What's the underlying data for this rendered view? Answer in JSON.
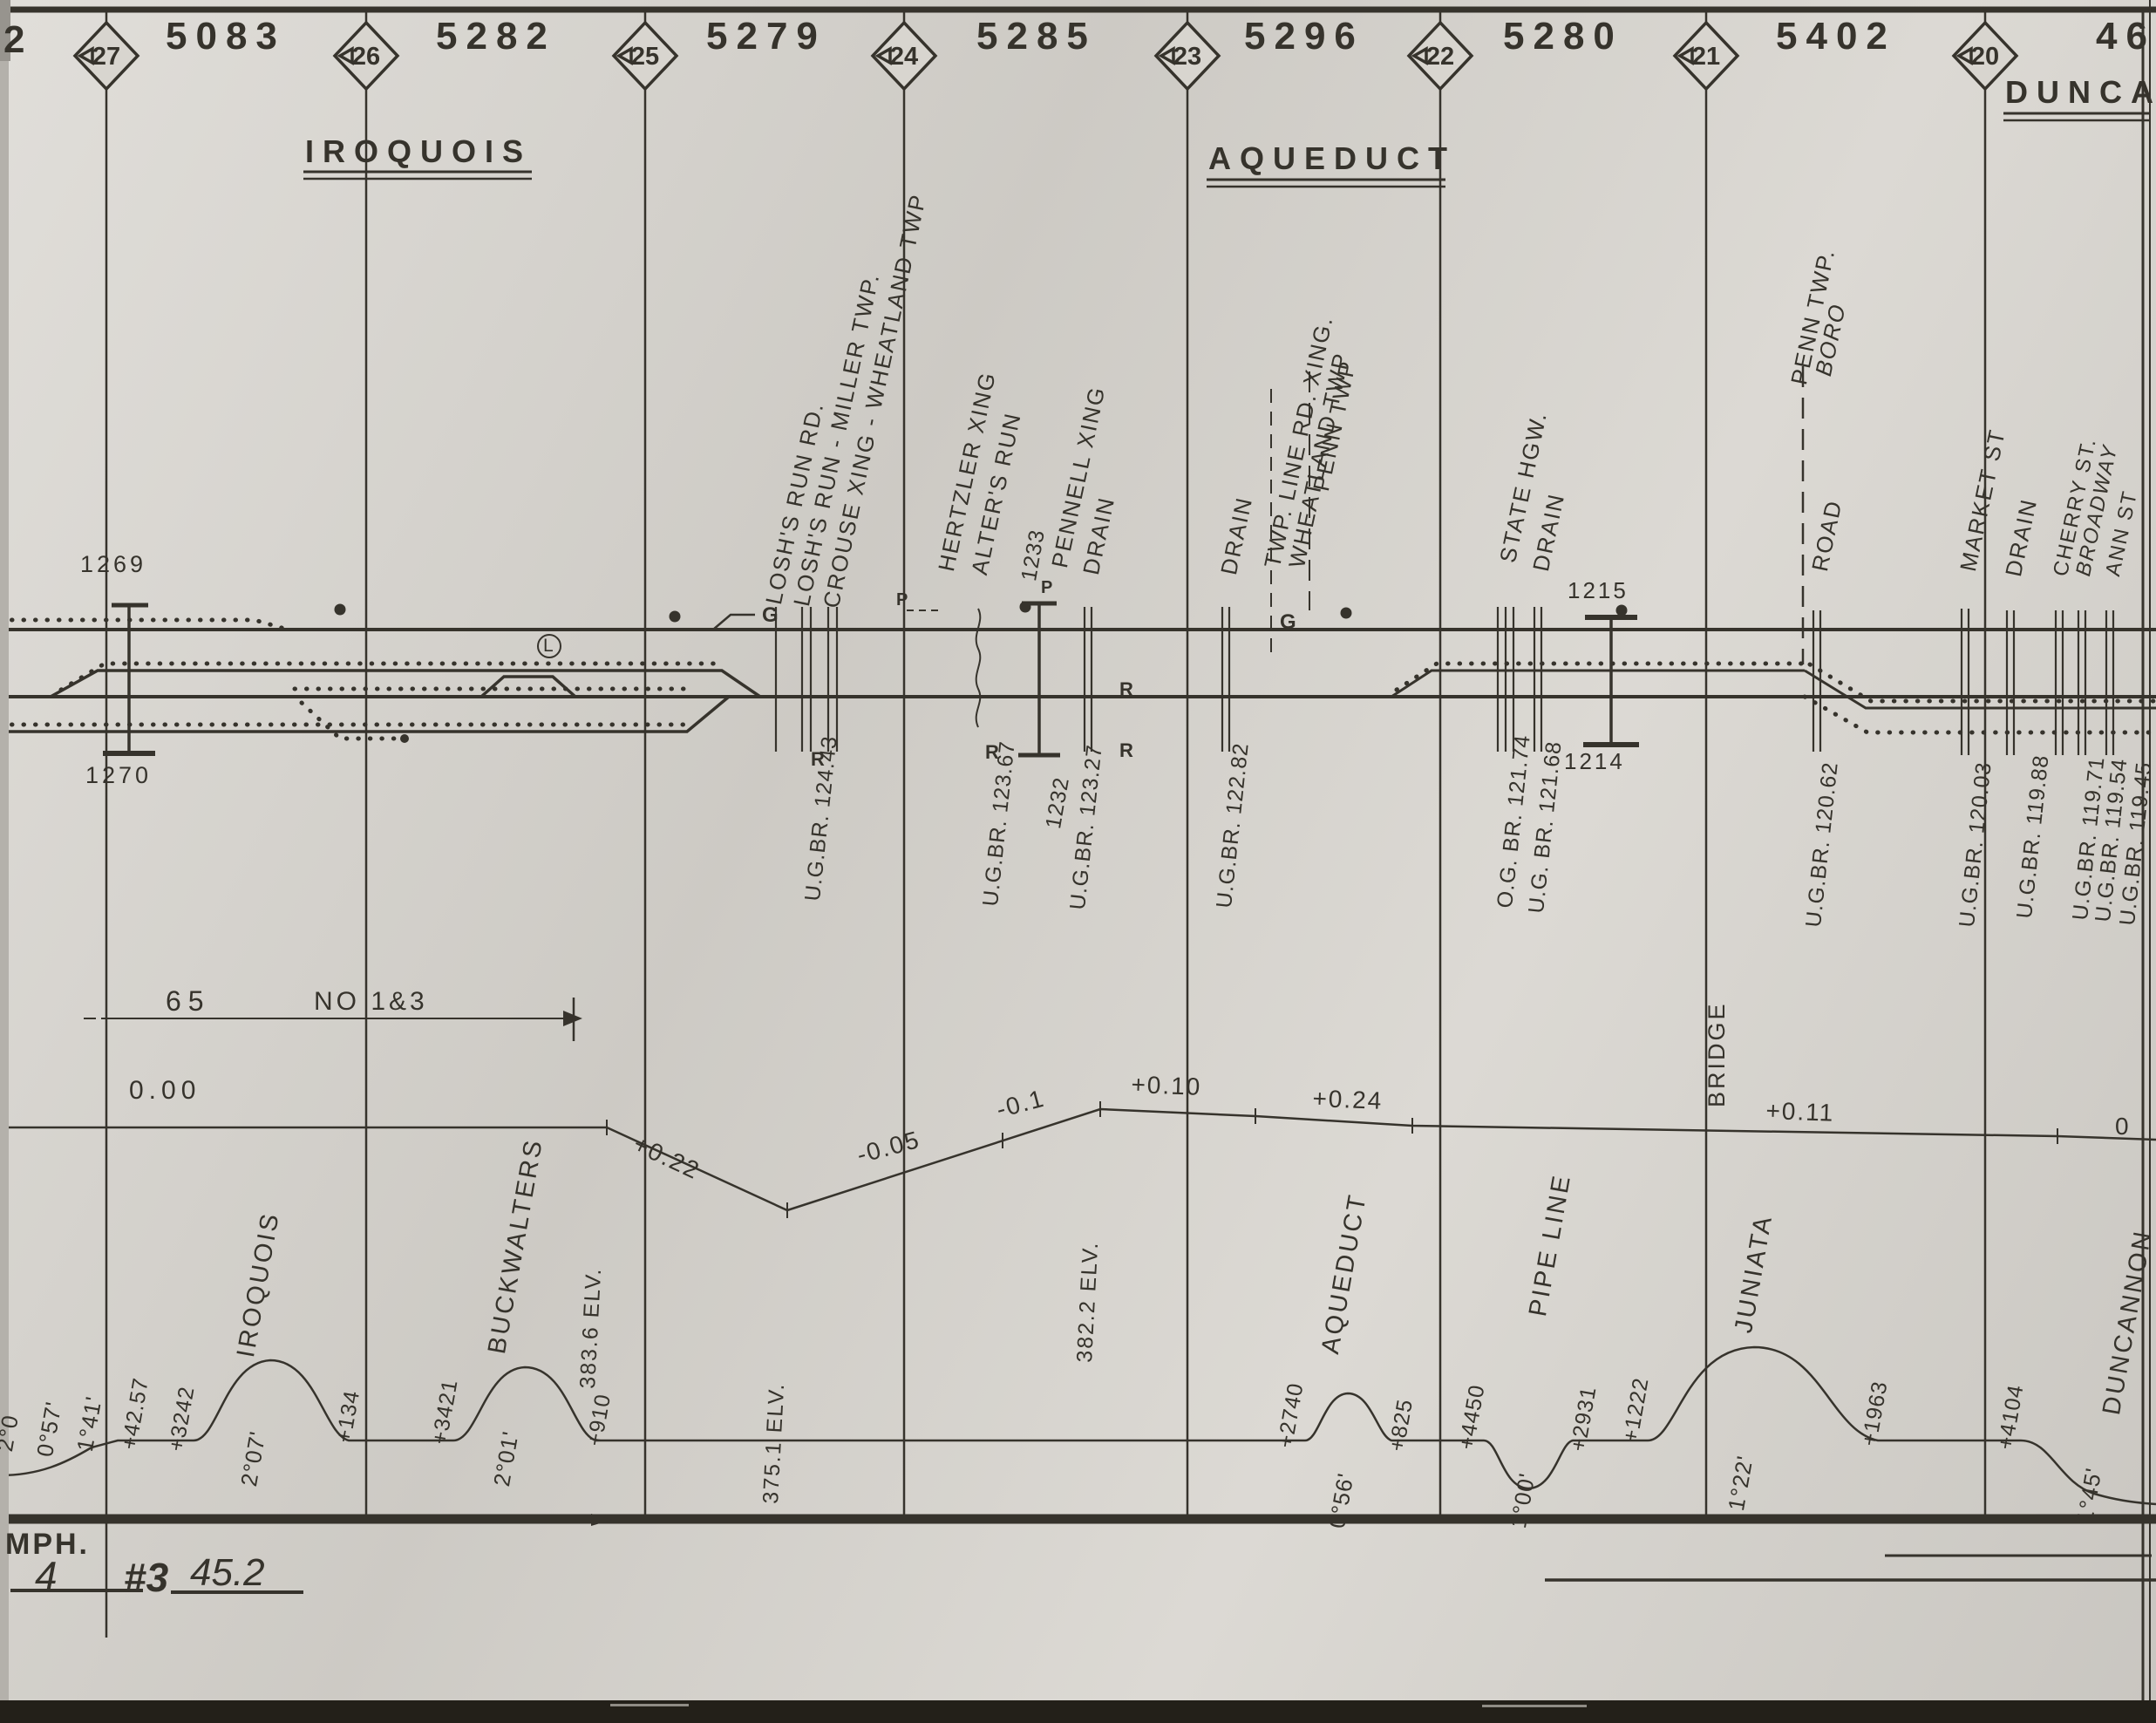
{
  "sheet": {
    "left_edge_number": "2",
    "mph_note": "MPH.",
    "hand_track": "4",
    "hand_no": "#3",
    "hand_speed": "45.2"
  },
  "top_row": {
    "sections": [
      "5083",
      "5282",
      "5279",
      "5285",
      "5296",
      "5280",
      "5402",
      "46"
    ],
    "mileposts": [
      "27",
      "26",
      "25",
      "24",
      "23",
      "22",
      "21",
      "20"
    ]
  },
  "stations": {
    "iroquois": "IROQUOIS",
    "aqueduct": "AQUEDUCT",
    "duncannon_partial": "DUNCA"
  },
  "features": {
    "losh_run_rd": "LOSH'S RUN RD.",
    "losh_run_miller": "LOSH'S RUN - MILLER TWP.",
    "crouse_wheatland": "CROUSE XING - WHEATLAND TWP",
    "hertzler": "HERTZLER XING",
    "alters_run": "ALTER'S RUN",
    "pennell": "PENNELL XING",
    "drain1": "DRAIN",
    "drain2": "DRAIN",
    "twp_line_xing": "TWP. LINE RD. XING.",
    "wheatland_twp": "WHEATLAND TWP",
    "penn_twp": "PENN TWP",
    "state_hgw": "STATE HGW.",
    "drain3": "DRAIN",
    "penn_twp_boro_a": "PENN TWP.",
    "penn_twp_boro_b": "BORO",
    "road": "ROAD",
    "market_st": "MARKET ST",
    "drain4": "DRAIN",
    "cherry_st": "CHERRY ST.",
    "broadway": "BROADWAY",
    "ann_st": "ANN ST",
    "gate_g1": "G",
    "gate_g2": "G",
    "p1": "P",
    "p2": "P"
  },
  "track_marks": {
    "b1269": "1269",
    "b1270": "1270",
    "n1233": "1233",
    "n1232": "1232",
    "b1215": "1215",
    "b1214": "1214",
    "r1": "R",
    "r2": "R",
    "r3": "R",
    "r4": "R",
    "l_circle": "L"
  },
  "bridges": [
    "U.G.BR. 124.43",
    "U.G.BR. 123.67",
    "U.G.BR. 123.27",
    "U.G.BR. 122.82",
    "O.G. BR. 121.74",
    "U.G. BR. 121.68",
    "U.G.BR. 120.62",
    "U.G.BR. 120.03",
    "U.G.BR. 119.88",
    "U.G.BR. 119.71",
    "U.G.BR. 119.54",
    "U.G.BR. 119.45"
  ],
  "profile": {
    "flat": "0.00",
    "g1": "+0.22",
    "g2": "-0.05",
    "g3": "-0.1",
    "g4": "+0.10",
    "g5": "+0.24",
    "g6": "+0.11",
    "end": "0",
    "elev1": "383.6 ELV.",
    "elev2": "375.1 ELV.",
    "elev3": "382.2 ELV.",
    "bridge_note": "BRIDGE",
    "dim_a": "65",
    "dim_b": "NO 1&3"
  },
  "curves": {
    "c0_partial": "2°0",
    "c1": "0°57'",
    "c2": "1°41'",
    "s1": "+42.57",
    "s2": "+3242",
    "c3": "2°07'",
    "n3": "IROQUOIS",
    "s3": "+134",
    "s4": "+3421",
    "c4": "2°01'",
    "n4": "BUCKWALTERS",
    "s5": "+910",
    "s6": "+2740",
    "c5": "0°56'",
    "n5": "AQUEDUCT",
    "s7": "+825",
    "s8": "+4450",
    "c6": "1°00'",
    "n6": "PIPE LINE",
    "s9": "+2931",
    "s10": "+1222",
    "c7": "1°22'",
    "n7": "JUNIATA",
    "s11": "+1963",
    "s12": "+4104",
    "c8": "1°45'",
    "n8": "DUNCANNON"
  },
  "colors": {
    "ink": "#36332c",
    "paper": "#d8d5cf"
  }
}
